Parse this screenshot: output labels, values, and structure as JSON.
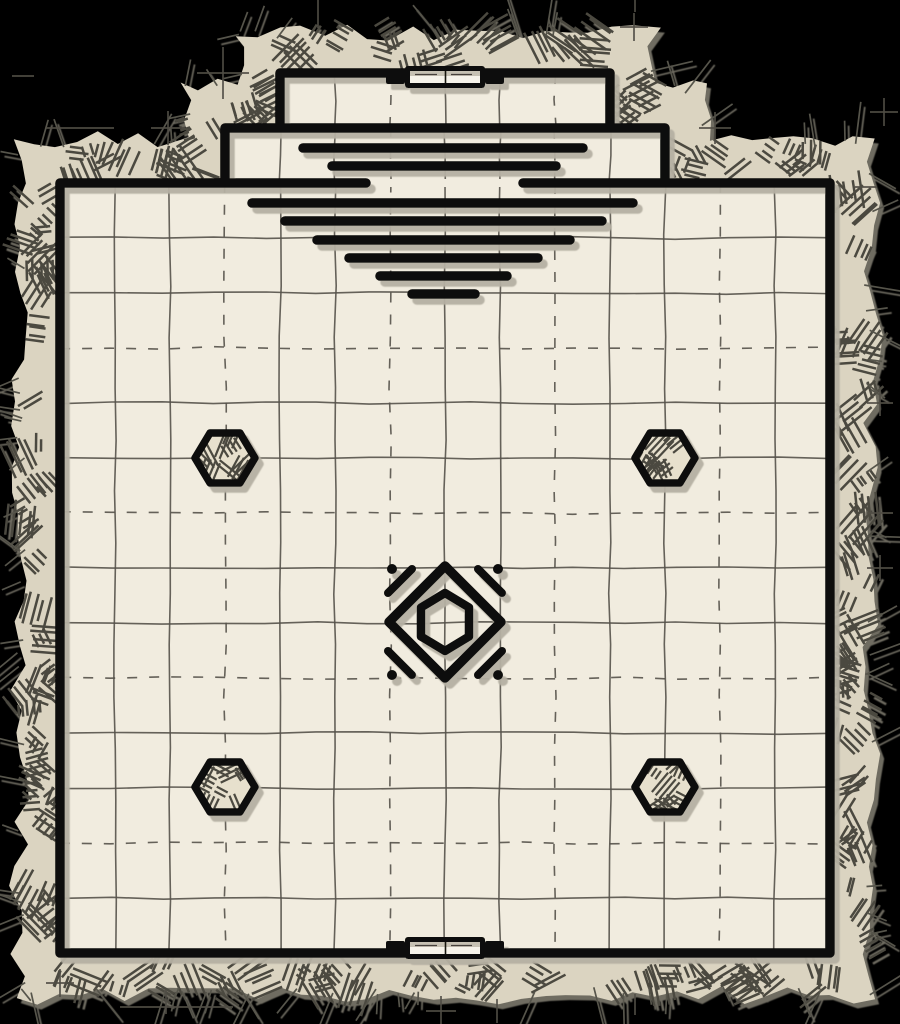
{
  "canvas": {
    "width": 900,
    "height": 1024,
    "background": "#000000"
  },
  "colors": {
    "floor": "#f1ecdf",
    "wall": "#0d0c09",
    "rock_base": "#dbd4c1",
    "rock_stroke": "#4c4940",
    "whisker": "#57544b",
    "grid": "#55524a",
    "shadow": "#b5b0a3",
    "rock_shadow": "#8a8679",
    "mark": "#504d45",
    "pillar_fill": "#e7e0cd",
    "door_inner_light": "#f6f3ea",
    "door_inner_shade": "#c6c1b3",
    "door_detail": "#44413a"
  },
  "grid": {
    "unit": 55,
    "origin_x": 60,
    "origin_y": 183,
    "dashed_every": 3,
    "dash_pattern": "10 12",
    "line_width": 1.6
  },
  "rooms": {
    "main": {
      "x": 60,
      "y": 183,
      "w": 770,
      "h": 770
    },
    "middle": {
      "x": 225,
      "y": 128,
      "w": 440,
      "h": 55
    },
    "top": {
      "x": 280,
      "y": 73,
      "w": 330,
      "h": 55
    }
  },
  "walls": {
    "thickness": 9.5,
    "north_gap": {
      "x1": 366,
      "x2": 523
    },
    "paths": {
      "main": "M366,183 H60 V953 H830 V183 H523",
      "middle": "M225,182 V128 H665 V182",
      "top": "M280,127 V73 H610 V127"
    }
  },
  "stairs": {
    "center_x": 445,
    "line_thickness": 9.5,
    "lines": [
      {
        "y": 148,
        "x1": 303,
        "x2": 583
      },
      {
        "y": 166,
        "x1": 332,
        "x2": 556
      },
      {
        "y": 203,
        "x1": 252,
        "x2": 633
      },
      {
        "y": 221,
        "x1": 285,
        "x2": 602
      },
      {
        "y": 240,
        "x1": 317,
        "x2": 570
      },
      {
        "y": 258,
        "x1": 349,
        "x2": 538
      },
      {
        "y": 276,
        "x1": 380,
        "x2": 507
      },
      {
        "y": 294,
        "x1": 412,
        "x2": 475
      }
    ]
  },
  "doors": [
    {
      "id": "north",
      "cx": 445,
      "cy": 77
    },
    {
      "id": "south",
      "cx": 445,
      "cy": 948
    }
  ],
  "pillars": [
    {
      "cx": 225,
      "cy": 458
    },
    {
      "cx": 665,
      "cy": 458
    },
    {
      "cx": 225,
      "cy": 787
    },
    {
      "cx": 665,
      "cy": 787
    }
  ],
  "pillar_style": {
    "rx": 30,
    "ry": 25,
    "outline": 7.5
  },
  "ornament": {
    "cx": 445,
    "cy": 622,
    "diamond_r": 56,
    "diamond_stroke": 9.5,
    "hex_rx": 24,
    "hex_ry": 29,
    "hex_stroke": 8.5,
    "corner_stroke_w": 8,
    "dot_r": 5,
    "dot_dist": 53
  },
  "rock": {
    "band_width": 45,
    "base_outline": [
      [
        60,
        183
      ],
      [
        225,
        183
      ],
      [
        225,
        128
      ],
      [
        280,
        128
      ],
      [
        280,
        73
      ],
      [
        610,
        73
      ],
      [
        610,
        128
      ],
      [
        665,
        128
      ],
      [
        665,
        183
      ],
      [
        830,
        183
      ],
      [
        830,
        953
      ],
      [
        60,
        953
      ]
    ],
    "offset_outline": [
      [
        15,
        138
      ],
      [
        180,
        138
      ],
      [
        180,
        83
      ],
      [
        235,
        83
      ],
      [
        235,
        28
      ],
      [
        655,
        28
      ],
      [
        655,
        83
      ],
      [
        710,
        83
      ],
      [
        710,
        138
      ],
      [
        875,
        138
      ],
      [
        875,
        998
      ],
      [
        15,
        998
      ]
    ]
  },
  "outside_marks": [
    {
      "t": "v",
      "x": 318,
      "y1": 0,
      "y2": 28
    },
    {
      "t": "cross",
      "x": 634,
      "y": 27,
      "arm": 14
    },
    {
      "t": "v",
      "x": 635,
      "y1": 0,
      "y2": 12
    },
    {
      "t": "cross",
      "x": 223,
      "y": 73,
      "arm": 26
    },
    {
      "t": "h",
      "x1": 12,
      "x2": 34,
      "y": 76
    },
    {
      "t": "cross",
      "x": 168,
      "y": 128,
      "arm": 17
    },
    {
      "t": "h",
      "x1": 46,
      "x2": 114,
      "y": 128
    },
    {
      "t": "cross",
      "x": 715,
      "y": 128,
      "arm": 16
    },
    {
      "t": "h",
      "x1": 855,
      "x2": 877,
      "y": 187
    },
    {
      "t": "cross",
      "x": 884,
      "y": 112,
      "arm": 14
    },
    {
      "t": "cross",
      "x": 880,
      "y": 403,
      "arm": 13
    },
    {
      "t": "cross",
      "x": 880,
      "y": 513,
      "arm": 13
    },
    {
      "t": "cross",
      "x": 880,
      "y": 568,
      "arm": 13
    },
    {
      "t": "cross",
      "x": 60,
      "y": 983,
      "arm": 14
    },
    {
      "t": "h",
      "x1": 120,
      "x2": 233,
      "y": 1007
    },
    {
      "t": "v",
      "x": 166,
      "y1": 990,
      "y2": 1014
    },
    {
      "t": "cross",
      "x": 441,
      "y": 1011,
      "arm": 15
    },
    {
      "t": "v",
      "x": 497,
      "y1": 999,
      "y2": 1023
    },
    {
      "t": "v",
      "x": 635,
      "y1": 994,
      "y2": 1015
    }
  ]
}
